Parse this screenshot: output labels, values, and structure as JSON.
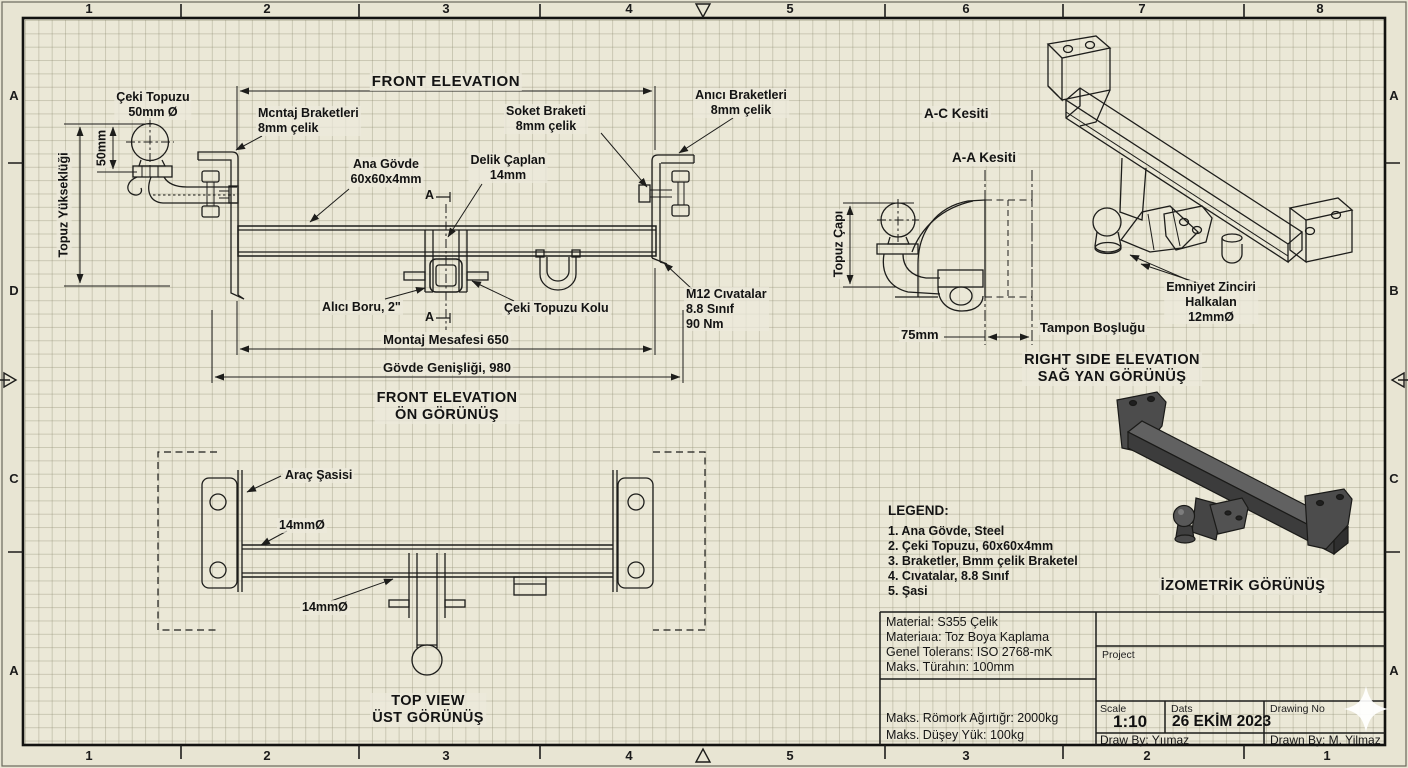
{
  "sheet": {
    "border": {
      "top_numbers": [
        "1",
        "2",
        "3",
        "4",
        "5",
        "6",
        "7",
        "8"
      ],
      "bottom_numbers": [
        "1",
        "2",
        "3",
        "4",
        "5",
        "3",
        "2",
        "1"
      ],
      "left_letters": [
        "A",
        "D",
        "C",
        "A"
      ],
      "right_letters": [
        "A",
        "B",
        "C",
        "A"
      ]
    },
    "front_elevation": {
      "title": "FRONT ELEVATION",
      "ball_label": "Çeki Topuzu\n50mm Ø",
      "mount_bracket_label": "Mcntaj Braketleri\n8mm çelik",
      "socket_bracket_label": "Soket Braketi\n8mm çelik",
      "main_bracket_label": "Anıcı Braketleri\n8mm çelik",
      "main_body_label": "Ana Gövde\n60x60x4mm",
      "hole_dia_label": "Delik Çaplan\n14mm",
      "bolt_label": "M12 Cıvatalar\n8.8 Sınıf\n90 Nm",
      "receiver_label": "Alıcı Boru, 2\"",
      "ball_arm_label": "Çeki Topuzu Kolu",
      "section_marker_top": "A",
      "section_marker_bottom": "A",
      "dim_mount_distance": "Montaj Mesafesi 650",
      "dim_body_width": "Gövde Genişliği, 980",
      "dim_ball_height": "Topuz Yükseklüği",
      "dim_50mm": "50mm",
      "caption": "FRONT ELEVATION\nÖN GÖRÜNÜŞ"
    },
    "top_view": {
      "chassis_label": "Araç Şasisi",
      "hole1_label": "14mmØ",
      "hole2_label": "14mmØ",
      "caption": "TOP VIEW\nÜST GÖRÜNÜŞ"
    },
    "side_view": {
      "section_ac": "A-C Kesiti",
      "section_aa": "A-A Kesiti",
      "dim_ball_dia": "Topuz Çapı",
      "dim_75": "75mm",
      "bumper_label": "Tampon Boşluğu",
      "caption": "RIGHT SIDE ELEVATION\nSAĞ YAN GÖRÜNÜŞ"
    },
    "isometric": {
      "chain_label": "Emniyet Zinciri\nHalkalan\n12mmØ",
      "caption": "İZOMETRİK GÖRÜNÜŞ"
    },
    "legend": {
      "title": "LEGEND:",
      "items": [
        "1. Ana Gövde, Steel",
        "2. Çeki Topuzu, 60x60x4mm",
        "3. Braketler, Bmm çelik Braketel",
        "4. Cıvatalar, 8.8 Sınıf",
        "5. Şasi"
      ]
    },
    "title_block": {
      "material": "Material: S355 Çelik",
      "coating": "Materiaıa: Toz Boya Kaplama",
      "tolerance": "Genel Tolerans: ISO 2768-mK",
      "max_overhang": "Maks. Türahın: 100mm",
      "max_trailer": "Maks. Römork Ağırtığr: 2000kg",
      "max_vertical": "Maks. Düşey Yük: 100kg",
      "project_label": "Project",
      "scale_label": "Scale",
      "scale_value": "1:10",
      "date_label": "Dats",
      "date_value": "26 EKİM 2023",
      "drawing_no_label": "Drawing No",
      "draw_by": "Draw By: Yıımaz",
      "drawn_by": "Drawn By: M. Yilmaz"
    }
  }
}
